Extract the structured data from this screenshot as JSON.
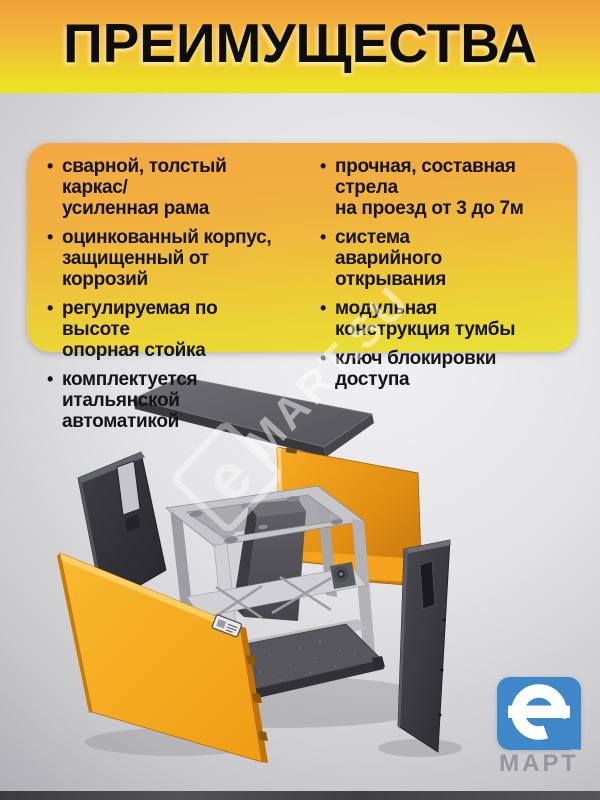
{
  "header": {
    "title": "ПРЕИМУЩЕСТВА"
  },
  "advantages": {
    "left": [
      {
        "text": "сварной, толстый каркас/\nусиленная рама"
      },
      {
        "text": "оцинкованный корпус,\nзащищенный от коррозий"
      },
      {
        "text": "регулируемая по высоте\nопорная стойка"
      },
      {
        "text": "комплектуется\nитальянской автоматикой"
      }
    ],
    "right": [
      {
        "text": "прочная, составная стрела\nна проезд от 3 до 7м"
      },
      {
        "text": "система\nаварийного открывания"
      },
      {
        "text": "модульная\nконструкция тумбы"
      },
      {
        "text": "ключ блокировки\nдоступа"
      }
    ]
  },
  "watermark": {
    "text": "MART.SU",
    "logo_letter": "е"
  },
  "brand": {
    "logo_letter": "е",
    "name": "МАРТ"
  },
  "diagram": {
    "type": "exploded-view",
    "parts": [
      "top-cover-panel",
      "left-rear-panel",
      "rear-orange-panel",
      "internal-frame-with-drive",
      "front-orange-panel",
      "right-door-panel"
    ]
  },
  "colors": {
    "header_orange": "#f0a43c",
    "header_yellow": "#e9e32a",
    "card_orange": "#f2a440",
    "card_yellow": "#eade33",
    "panel_orange": "#f3a01c",
    "logo_blue": "#3e87c9",
    "background_gray": "#c9c9cc"
  }
}
